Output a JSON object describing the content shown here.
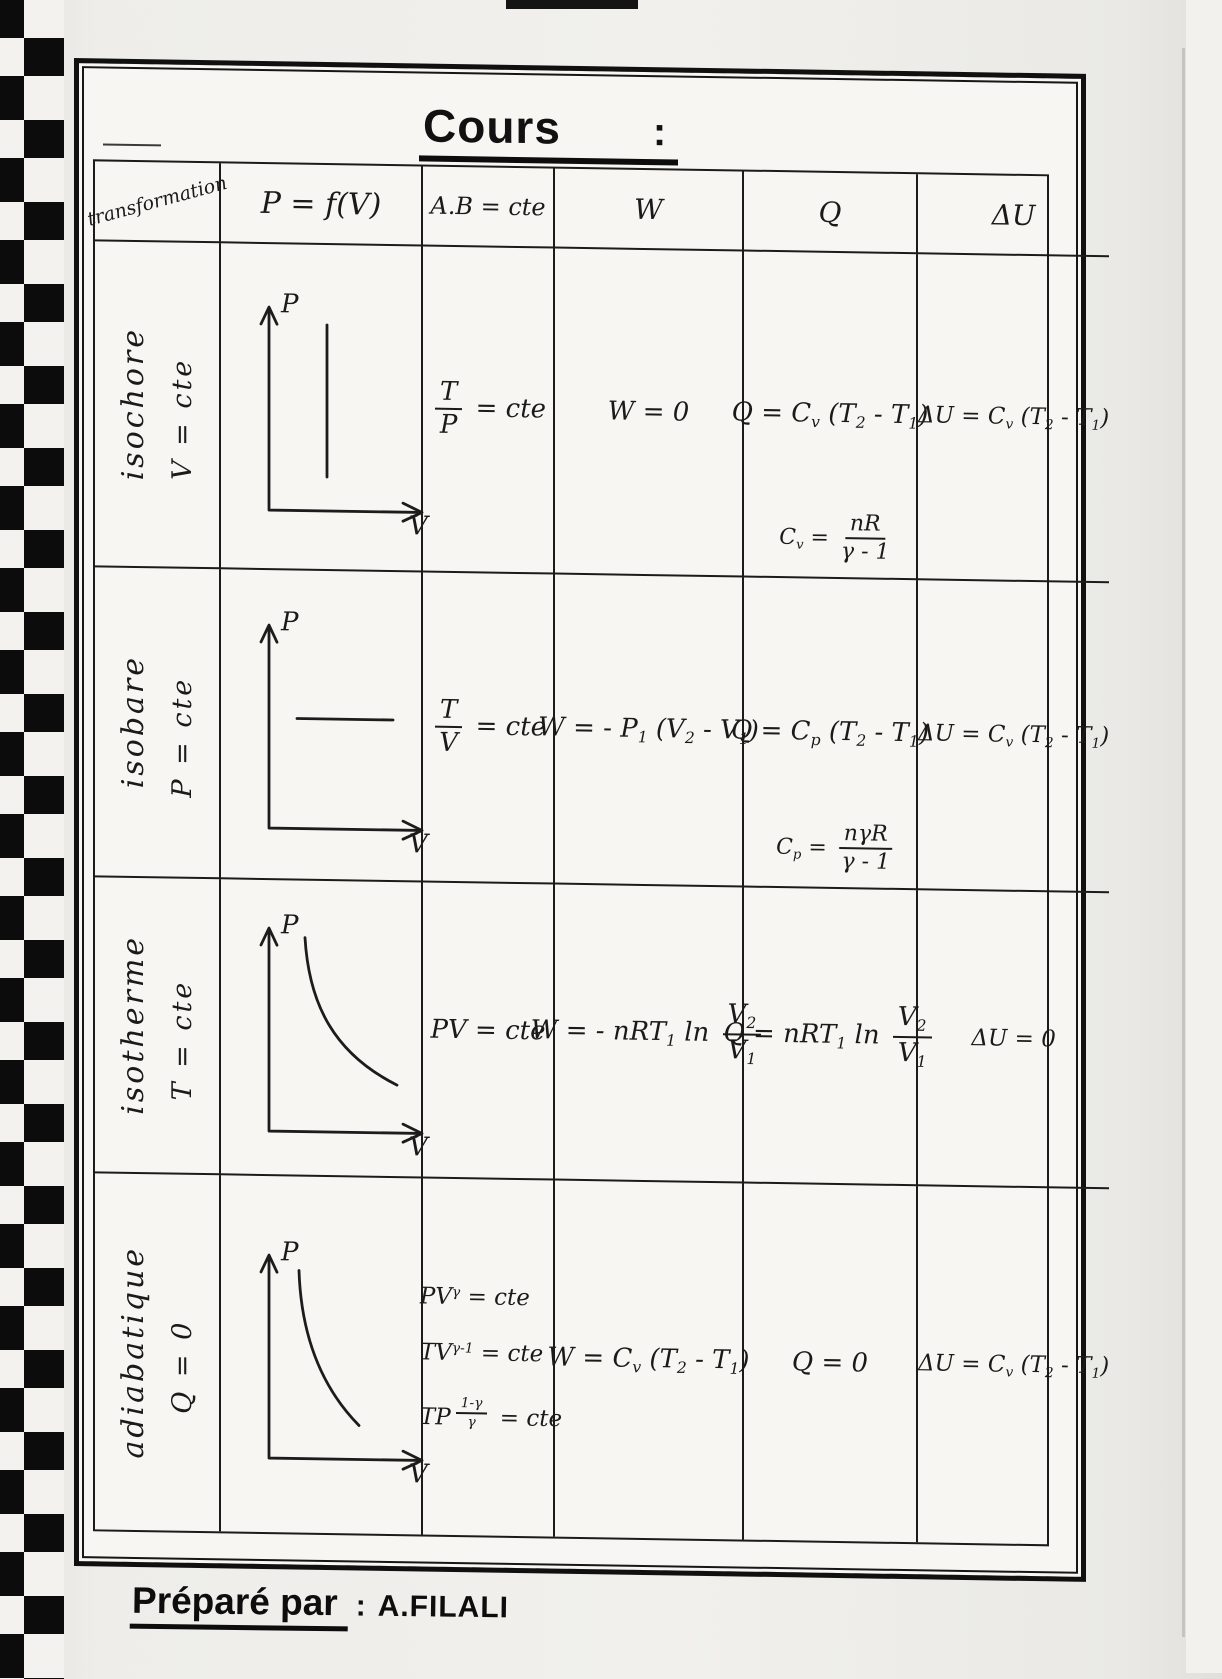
{
  "page": {
    "title": "Cours",
    "title_colon": ":",
    "footer": {
      "label": "Préparé par",
      "separator": ":",
      "author": "A.FILALI"
    },
    "ink": "#1a1a1a",
    "paper": "#f7f6f2"
  },
  "table": {
    "headers": {
      "transformation": "transformation",
      "graph": "P = f(V)",
      "relation": "A.B = cte",
      "work": "W",
      "heat": "Q",
      "internal_energy": "ΔU"
    },
    "rows": [
      {
        "name": "isochore",
        "condition": "V = cte",
        "graph": {
          "y_axis": "P",
          "x_axis": "V",
          "curve": "vertical-line"
        },
        "relation": [
          {
            "frac": {
              "num": [
                {
                  "t": "T"
                }
              ],
              "den": [
                {
                  "t": "P"
                }
              ]
            }
          },
          {
            "t": " = cte"
          }
        ],
        "work": [
          {
            "t": "W = 0"
          }
        ],
        "heat": [
          {
            "t": "Q = C"
          },
          {
            "sub": "v"
          },
          {
            "t": " (T"
          },
          {
            "sub": "2"
          },
          {
            "t": " - T"
          },
          {
            "sub": "1"
          },
          {
            "t": ")"
          }
        ],
        "heat_note": [
          {
            "t": "C"
          },
          {
            "sub": "v"
          },
          {
            "t": " = "
          },
          {
            "frac": {
              "num": [
                {
                  "t": "nR"
                }
              ],
              "den": [
                {
                  "t": "γ - 1"
                }
              ]
            }
          }
        ],
        "internal_energy": [
          {
            "t": "ΔU = C"
          },
          {
            "sub": "v"
          },
          {
            "t": " (T"
          },
          {
            "sub": "2"
          },
          {
            "t": " - T"
          },
          {
            "sub": "1"
          },
          {
            "t": ")"
          }
        ]
      },
      {
        "name": "isobare",
        "condition": "P = cte",
        "graph": {
          "y_axis": "P",
          "x_axis": "V",
          "curve": "horizontal-line"
        },
        "relation": [
          {
            "frac": {
              "num": [
                {
                  "t": "T"
                }
              ],
              "den": [
                {
                  "t": "V"
                }
              ]
            }
          },
          {
            "t": " = cte"
          }
        ],
        "work": [
          {
            "t": "W = - P"
          },
          {
            "sub": "1"
          },
          {
            "t": " (V"
          },
          {
            "sub": "2"
          },
          {
            "t": " - V"
          },
          {
            "sub": "1"
          },
          {
            "t": ")"
          }
        ],
        "heat": [
          {
            "t": "Q = C"
          },
          {
            "sub": "p"
          },
          {
            "t": " (T"
          },
          {
            "sub": "2"
          },
          {
            "t": " - T"
          },
          {
            "sub": "1"
          },
          {
            "t": ")"
          }
        ],
        "heat_note": [
          {
            "t": "C"
          },
          {
            "sub": "p"
          },
          {
            "t": " = "
          },
          {
            "frac": {
              "num": [
                {
                  "t": "nγR"
                }
              ],
              "den": [
                {
                  "t": "γ - 1"
                }
              ]
            }
          }
        ],
        "internal_energy": [
          {
            "t": "ΔU = C"
          },
          {
            "sub": "v"
          },
          {
            "t": " (T"
          },
          {
            "sub": "2"
          },
          {
            "t": " - T"
          },
          {
            "sub": "1"
          },
          {
            "t": ")"
          }
        ]
      },
      {
        "name": "isotherme",
        "condition": "T = cte",
        "graph": {
          "y_axis": "P",
          "x_axis": "V",
          "curve": "hyperbola"
        },
        "relation": [
          {
            "t": "PV = cte"
          }
        ],
        "work": [
          {
            "t": "W = - nRT"
          },
          {
            "sub": "1"
          },
          {
            "t": " ln "
          },
          {
            "frac": {
              "num": [
                {
                  "t": "V"
                },
                {
                  "sub": "2"
                }
              ],
              "den": [
                {
                  "t": "V"
                },
                {
                  "sub": "1"
                }
              ]
            }
          }
        ],
        "heat": [
          {
            "t": "Q = nRT"
          },
          {
            "sub": "1"
          },
          {
            "t": " ln "
          },
          {
            "frac": {
              "num": [
                {
                  "t": "V"
                },
                {
                  "sub": "2"
                }
              ],
              "den": [
                {
                  "t": "V"
                },
                {
                  "sub": "1"
                }
              ]
            }
          }
        ],
        "internal_energy": [
          {
            "t": "ΔU = 0"
          }
        ]
      },
      {
        "name": "adiabatique",
        "condition": "Q = 0",
        "graph": {
          "y_axis": "P",
          "x_axis": "V",
          "curve": "steep-hyperbola"
        },
        "relations": [
          [
            {
              "t": "PV"
            },
            {
              "sup": "γ"
            },
            {
              "t": " = cte"
            }
          ],
          [
            {
              "t": "TV"
            },
            {
              "sup": "γ-1"
            },
            {
              "t": " = cte"
            }
          ],
          [
            {
              "t": "TP"
            },
            {
              "sup": [
                {
                  "frac": {
                    "num": [
                      {
                        "t": "1-γ"
                      }
                    ],
                    "den": [
                      {
                        "t": "γ"
                      }
                    ]
                  }
                }
              ]
            },
            {
              "t": " = cte"
            }
          ]
        ],
        "work": [
          {
            "t": "W = C"
          },
          {
            "sub": "v"
          },
          {
            "t": " (T"
          },
          {
            "sub": "2"
          },
          {
            "t": " - T"
          },
          {
            "sub": "1"
          },
          {
            "t": ")"
          }
        ],
        "heat": [
          {
            "t": "Q = 0"
          }
        ],
        "internal_energy": [
          {
            "t": "ΔU = C"
          },
          {
            "sub": "v"
          },
          {
            "t": " (T"
          },
          {
            "sub": "2"
          },
          {
            "t": " - T"
          },
          {
            "sub": "1"
          },
          {
            "t": ")"
          }
        ]
      }
    ]
  }
}
